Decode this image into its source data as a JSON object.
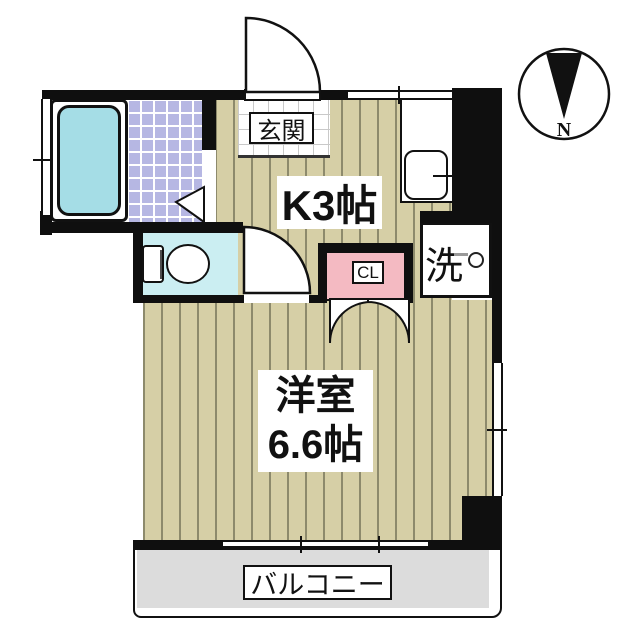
{
  "type": "japanese-apartment-floor-plan",
  "compass": {
    "label": "N"
  },
  "rooms": {
    "entrance": {
      "label": "玄関"
    },
    "kitchen": {
      "label": "K3帖"
    },
    "closet": {
      "label": "CL"
    },
    "laundry": {
      "label": "洗"
    },
    "western_room": {
      "name": "洋室",
      "size": "6.6帖"
    },
    "balcony": {
      "label": "バルコニー"
    }
  },
  "fixtures": [
    "bathtub",
    "toilet",
    "kitchen-sink",
    "washing-machine-tap"
  ],
  "colors": {
    "wall": "#0f0f0f",
    "flooring": "#d6cfa6",
    "bath_tile": "#b6b7e3",
    "bathtub": "#a5dde6",
    "toilet_floor": "#cbeef2",
    "closet_fill": "#f4bac2",
    "balcony_floor": "#dcdcdc"
  }
}
